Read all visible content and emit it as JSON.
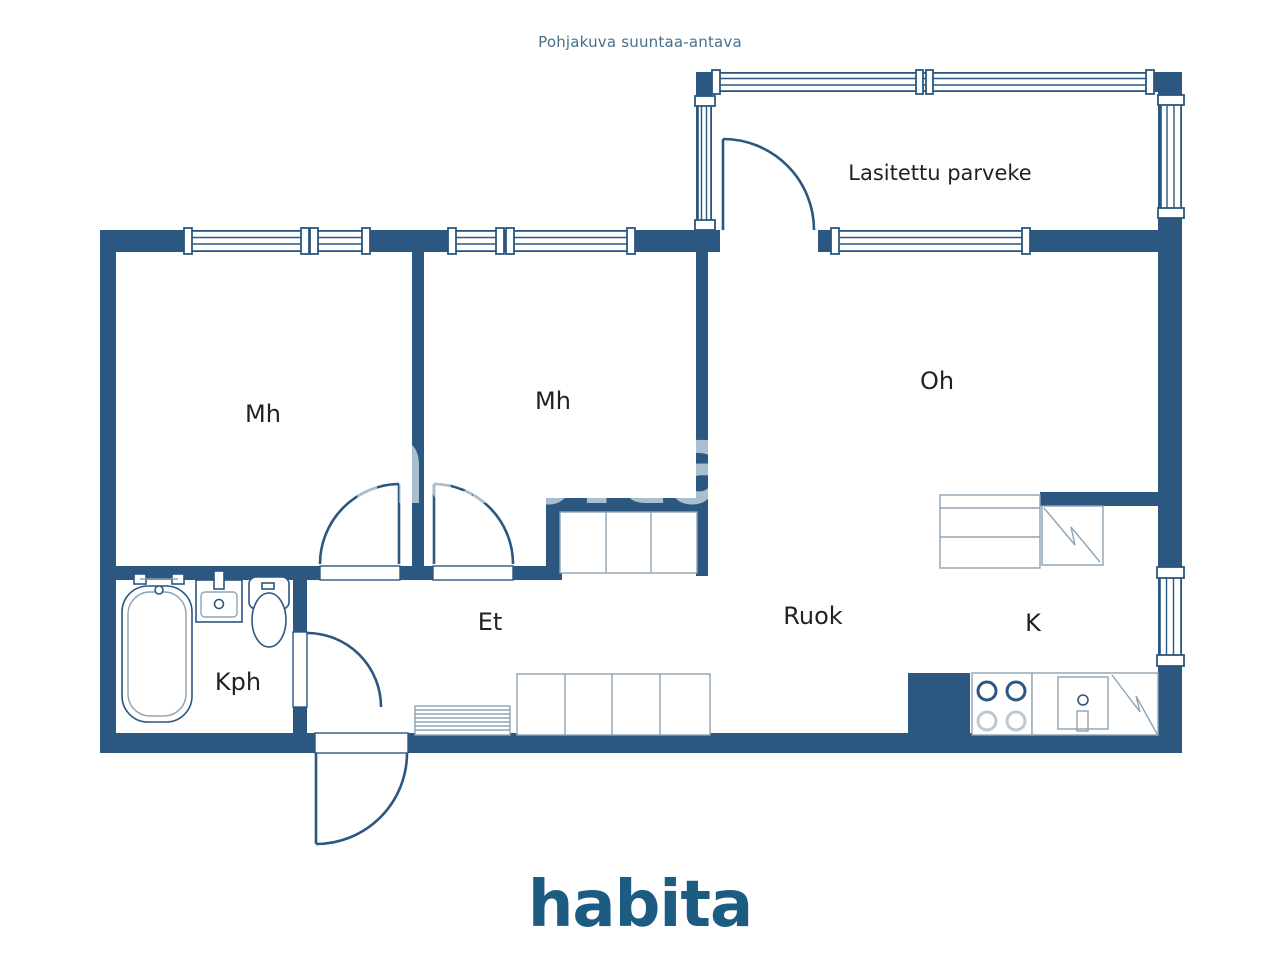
{
  "title": "Pohjakuva suuntaa-antava",
  "brand": {
    "logo": "habita",
    "watermark": "habita"
  },
  "rooms": {
    "balcony": "Lasitettu parveke",
    "bedroom1": "Mh",
    "bedroom2": "Mh",
    "living_room": "Oh",
    "entry": "Et",
    "dining": "Ruok",
    "kitchen": "K",
    "bathroom": "Kph"
  },
  "colors": {
    "wall": "#2b5780",
    "room_label": "#1f2126",
    "title_text": "#47708c",
    "logo": "#1d5c82",
    "watermark": "#a8bfd0",
    "background": "#ffffff"
  }
}
